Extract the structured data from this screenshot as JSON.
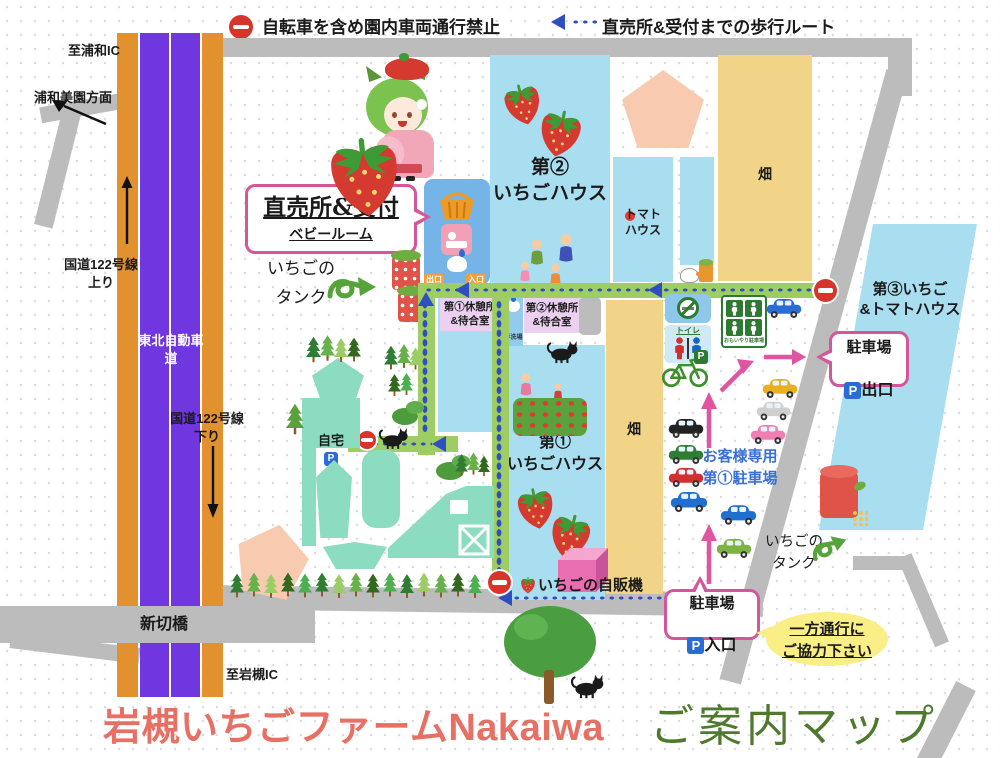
{
  "legend": {
    "no_vehicles": "自転車を含め園内車両通行禁止",
    "walk_route": "直売所&受付までの歩行ルート"
  },
  "roads": {
    "to_urawa_ic": "至浦和IC",
    "urawa_misono": "浦和美園方面",
    "route122_up": "国道122号線\n上り",
    "tohoku_expressway": "東北自動車道",
    "route122_down": "国道122号線\n下り",
    "shinkiri_bridge": "新切橋",
    "to_iwatsuki_ic": "至岩槻IC"
  },
  "sales": {
    "title": "直売所&受付",
    "baby_room": "ベビールーム",
    "exit_tag": "出口",
    "entrance_tag": "入口"
  },
  "tanks": {
    "left": "いちごの\nタンク",
    "right": "いちごの\nタンク"
  },
  "areas": {
    "house2": "第②\nいちごハウス",
    "tomato_house": "トマト\nハウス",
    "field_top": "畑",
    "field_bottom": "畑",
    "house3": "第③いちご\n&トマトハウス",
    "house1": "第①\nいちごハウス"
  },
  "rest": {
    "rest1": "第①休憩所\n&待合室",
    "rest2": "第②休憩所\n&待合室",
    "tearai": "手洗場"
  },
  "facilities": {
    "toilet": "トイレ",
    "omoiyari": "おもいやり駐車場"
  },
  "home": {
    "label": "自宅",
    "p": "P"
  },
  "parking": {
    "customer": "お客様専用\n第①駐車場",
    "exit_line1": "駐車場",
    "exit_line2": "出口",
    "entrance_line1": "駐車場",
    "entrance_line2": "入口",
    "p": "P",
    "cars_left": [
      "black",
      "green",
      "red",
      "blue"
    ],
    "cars_roadside": [
      "blue",
      "yellow",
      "white",
      "pink",
      "blue",
      "green"
    ]
  },
  "notes": {
    "one_way": "一方通行に\nご協力下さい"
  },
  "vending": {
    "label": "いちごの自販機"
  },
  "title": {
    "main": "岩槻いちごファームNakaiwa",
    "sub": "ご案内マップ"
  },
  "colors": {
    "highway_purple": "#7036df",
    "highway_orange": "#e2912f",
    "road_gray": "#bcbcbc",
    "house_blue": "#a9ddf0",
    "building_blue": "#74b4e6",
    "field_tan": "#f2d488",
    "pentagon_peach": "#f8cbb0",
    "path_green": "#9ecd63",
    "route_blue": "#2f4fc0",
    "accent_pink": "#d6569a",
    "rest_lavender": "#ecd0f0",
    "home_teal": "#8cdcc2",
    "arrow_pink": "#e0559f",
    "parking_text_blue": "#3a6fd8",
    "oneway_yellow": "#f9ef86",
    "title_red": "#e77065",
    "title_green": "#4f7a2e",
    "noentry_red": "#d7352c"
  }
}
